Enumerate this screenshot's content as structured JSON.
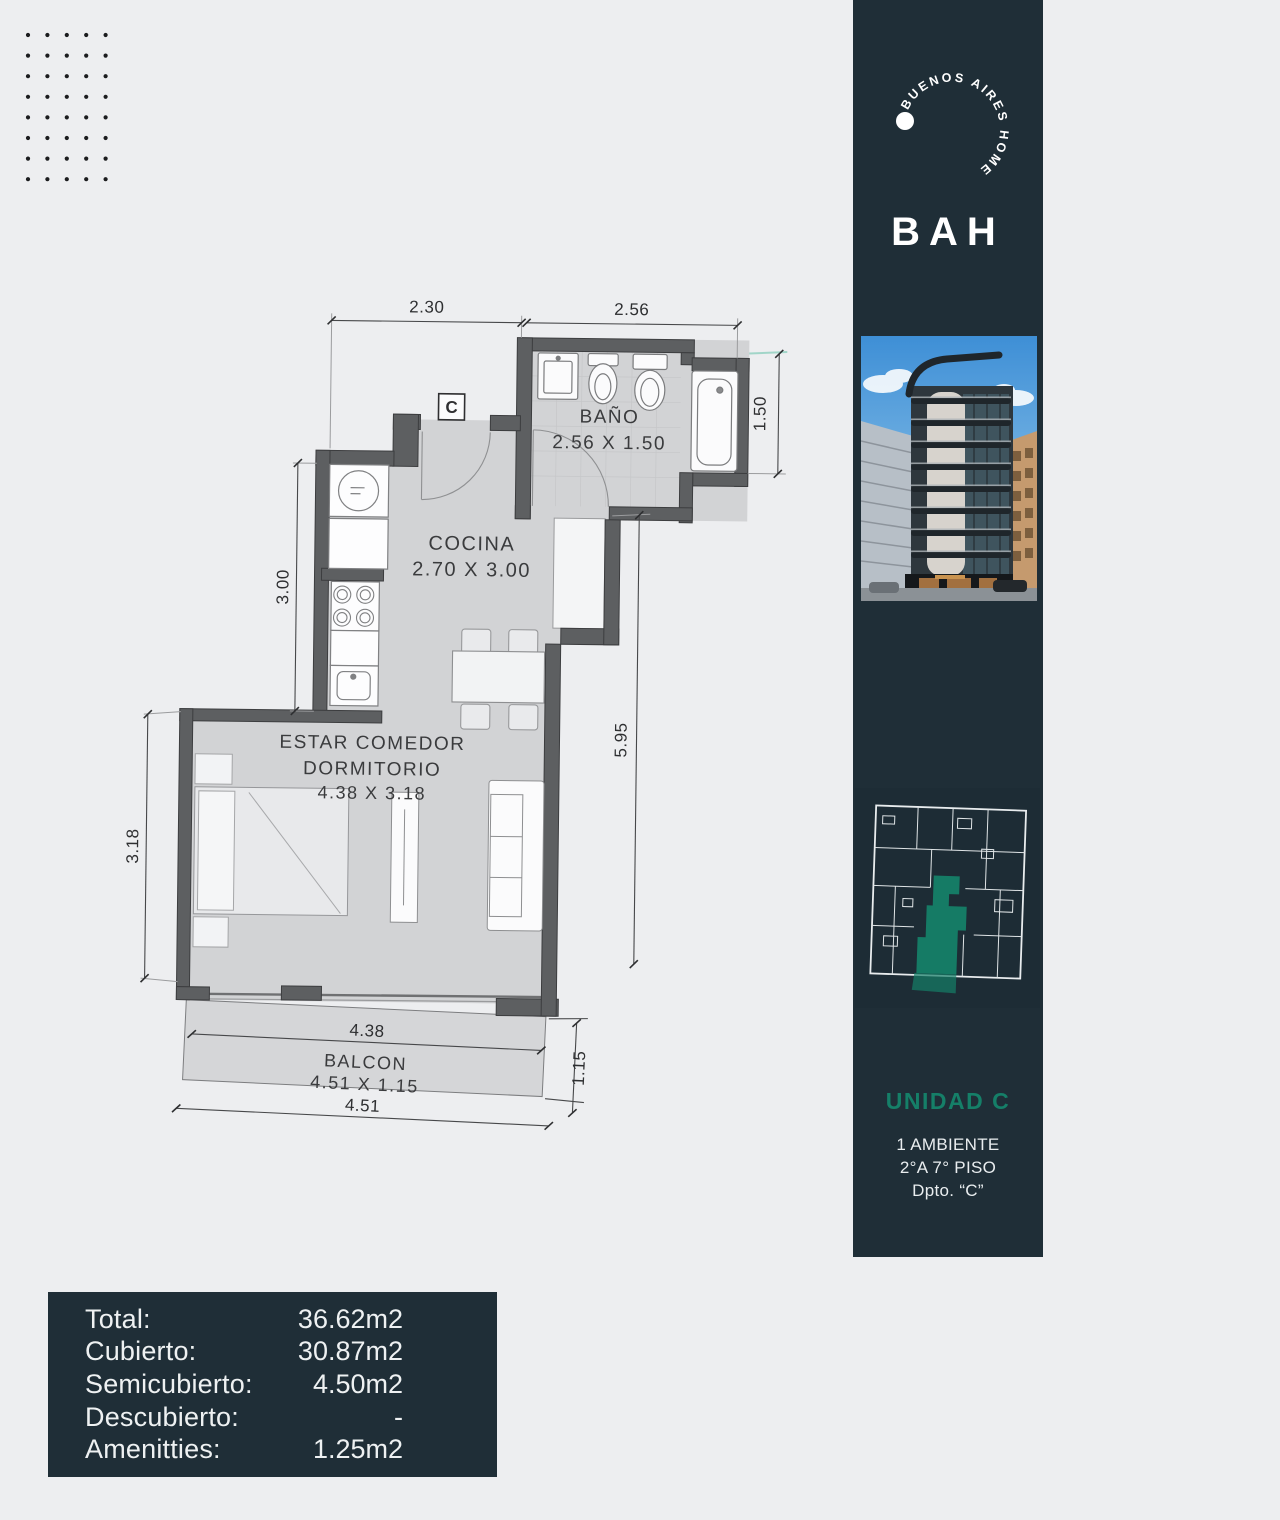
{
  "colors": {
    "background": "#edeef0",
    "sidebar_bg": "#1f2e37",
    "accent_green": "#157f68",
    "wall_gray": "#5d5f61",
    "floor_gray": "#d2d3d5"
  },
  "brand": {
    "circle_text": "BUENOS AIRES HOME",
    "wordmark": "BAH"
  },
  "sidebar": {
    "unit_title": "UNIDAD C",
    "info_lines": [
      "1 AMBIENTE",
      "2°A 7° PISO",
      "Dpto. “C”"
    ]
  },
  "plan": {
    "unit_marker": "C",
    "rooms": {
      "bano": {
        "name": "BAÑO",
        "dims": "2.56 X 1.50"
      },
      "cocina": {
        "name": "COCINA",
        "dims": "2.70 X 3.00"
      },
      "estar": {
        "line1": "ESTAR COMEDOR",
        "line2": "DORMITORIO",
        "dims": "4.38 X 3.18"
      },
      "balcon": {
        "name": "BALCON",
        "dims": "4.51 X 1.15"
      }
    },
    "dimensions": {
      "top_left": "2.30",
      "top_right": "2.56",
      "bath_side": "1.50",
      "kitchen_side": "3.00",
      "room_side": "3.18",
      "right_height": "5.95",
      "balcony_inner": "4.38",
      "balcony_outer": "4.51",
      "balcony_depth": "1.15"
    }
  },
  "summary": {
    "rows": [
      {
        "label": "Total:",
        "value": "36.62m2"
      },
      {
        "label": "Cubierto:",
        "value": "30.87m2"
      },
      {
        "label": "Semicubierto:",
        "value": "4.50m2"
      },
      {
        "label": "Descubierto:",
        "value": "-"
      },
      {
        "label": "Amenitties:",
        "value": "1.25m2"
      }
    ]
  }
}
